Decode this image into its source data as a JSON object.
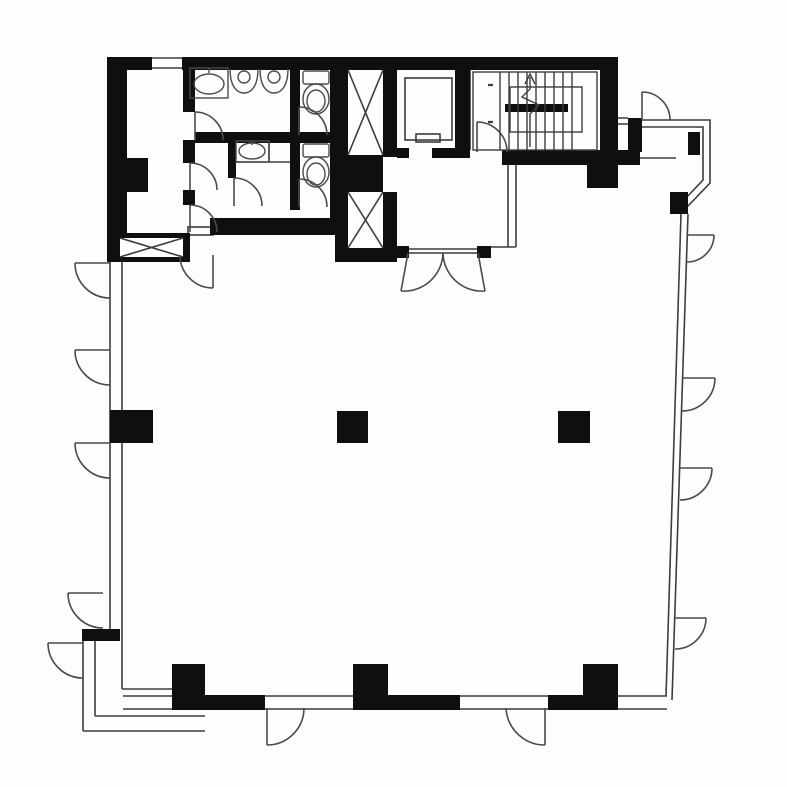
{
  "canvas": {
    "width": 787,
    "height": 787,
    "background": "#fdfdfd"
  },
  "colors": {
    "wall": "#0f0f0f",
    "line": "#3d3d3d",
    "door": "#4a4a4a",
    "fixture": "#4a4a4a",
    "white": "#ffffff"
  },
  "plan": {
    "kind": "architectural-floor-plan",
    "rooms": [
      {
        "id": "main-open-space"
      },
      {
        "id": "mens-restroom"
      },
      {
        "id": "womens-restroom"
      },
      {
        "id": "toilet-stall-upper"
      },
      {
        "id": "toilet-stall-lower"
      },
      {
        "id": "service-corridor"
      },
      {
        "id": "utility-shaft"
      },
      {
        "id": "elevator-shaft-upper"
      },
      {
        "id": "elevator-shaft-lower"
      },
      {
        "id": "elevator-cab-room"
      },
      {
        "id": "elevator-lobby"
      },
      {
        "id": "stairwell"
      },
      {
        "id": "balcony-top-right"
      },
      {
        "id": "balcony-bottom-left"
      }
    ],
    "fixtures": {
      "sinks": 2,
      "urinals": 2,
      "toilets": 2,
      "elevator_cars": 1,
      "stair_flights": 2
    },
    "structure": {
      "freestanding_columns": 6,
      "door_swings": 21,
      "shaft_cross_braces": 3
    }
  }
}
